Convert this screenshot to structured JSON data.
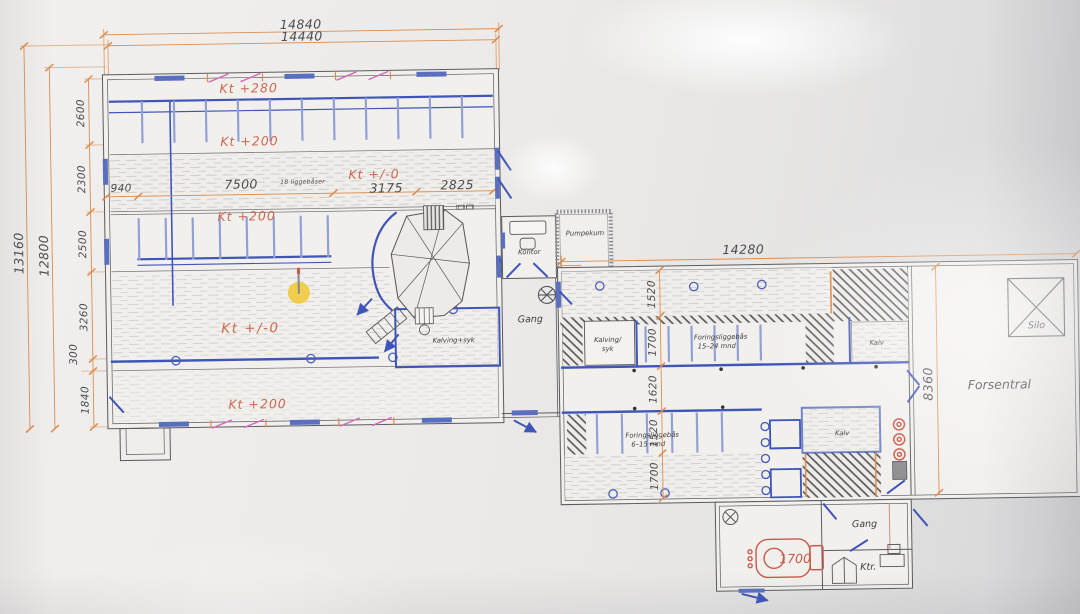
{
  "photo": {
    "paper_color": "#efedeb",
    "wall_color": "#d9d8da"
  },
  "colors": {
    "ink": "#55555a",
    "blue": "#3f55b8",
    "blue_light": "#93a0d6",
    "dim_orange": "#dd8c4e",
    "label_red": "#cd6750",
    "magenta": "#d468b8",
    "tank_red": "#c9584a",
    "highlight_yellow": "#f2c832"
  },
  "plan": {
    "dims_top": {
      "outer": "14840",
      "inner": "14440"
    },
    "dims_left": {
      "outer": "13160",
      "inner": "12800",
      "segments": [
        "2600",
        "2300",
        "2500",
        "3260",
        "300",
        "1840"
      ]
    },
    "dims_feed_row": {
      "a": "940",
      "b": "7500",
      "note": "18 liggebåser",
      "c": "3175",
      "d": "2825"
    },
    "dims_right": {
      "width": "14280",
      "height": "8360",
      "rows": [
        "1520",
        "1700",
        "1620",
        "1520",
        "1700"
      ]
    },
    "levels": {
      "kt280": "Kt +280",
      "kt200_a": "Kt +200",
      "kt0_mid": "Kt +/-0",
      "kt200_b": "Kt +200",
      "kt0_main": "Kt +/-0",
      "kt200_c": "Kt +200"
    },
    "rooms": {
      "kalving_syk_left": "Kalving+syk",
      "kontor": "Kontor",
      "pumpekum": "Pumpekum",
      "gang_mid": "Gang",
      "kalving_syk_right_1": "Kalving/",
      "kalving_syk_right_2": "syk",
      "forings_15_24_1": "Foringsliggebås",
      "forings_15_24_2": "15–24 mnd",
      "kalv_upper": "Kalv",
      "forings_6_15_1": "Foringsliggebås",
      "forings_6_15_2": "6–15 mnd",
      "kalv_lower": "Kalv",
      "forsentral": "Forsentral",
      "silo": "Silo",
      "gang_annex": "Gang",
      "ktr": "Ktr.",
      "tank_capacity": "1700"
    }
  }
}
